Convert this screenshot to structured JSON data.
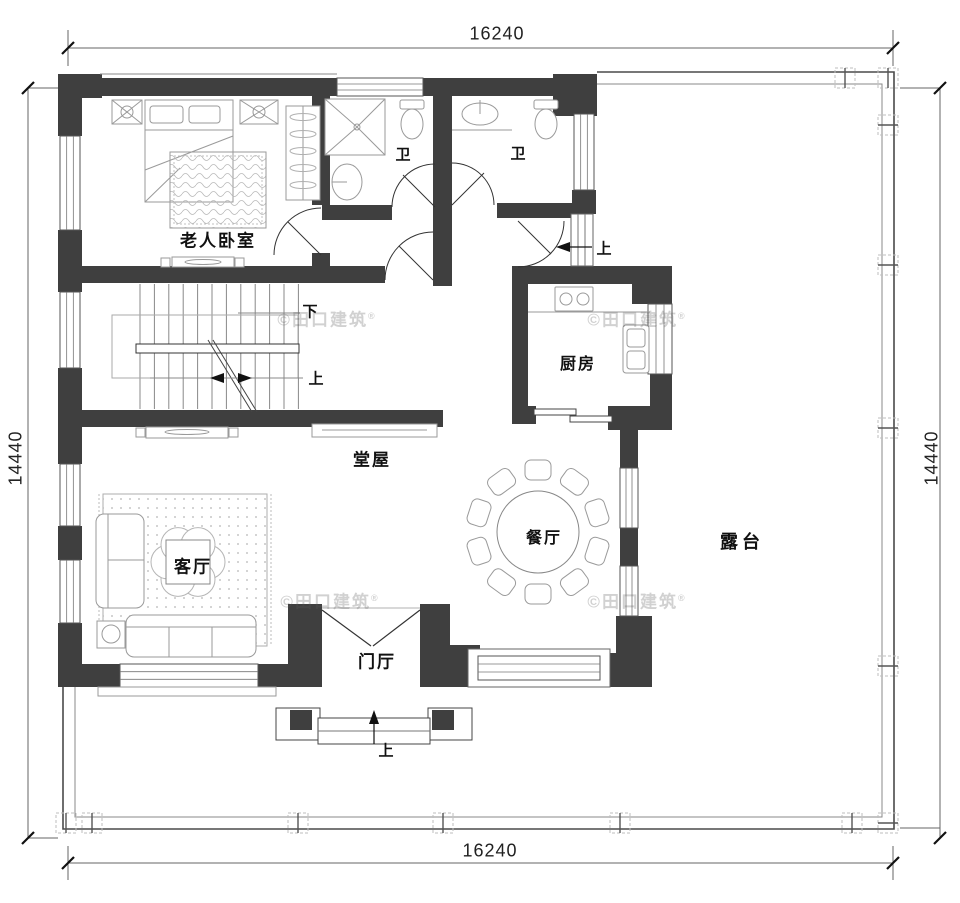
{
  "plan": {
    "dimensions": {
      "top": "16240",
      "bottom": "16240",
      "left": "14440",
      "right": "14440"
    },
    "rooms": {
      "bedroom": "老人卧室",
      "bath1": "卫",
      "bath2": "卫",
      "kitchen": "厨房",
      "hall": "堂屋",
      "living": "客厅",
      "dining": "餐厅",
      "foyer": "门厅",
      "terrace": "露台"
    },
    "stairs": {
      "down": "下",
      "up": "上"
    },
    "entry_steps": {
      "front": "上",
      "side": "上"
    },
    "watermark": {
      "text": "©田口建筑",
      "mark": "®"
    },
    "colors": {
      "wall": "#3f3f3f",
      "thin_line": "#555555",
      "dim_line": "#666666",
      "furniture": "#999999"
    }
  }
}
